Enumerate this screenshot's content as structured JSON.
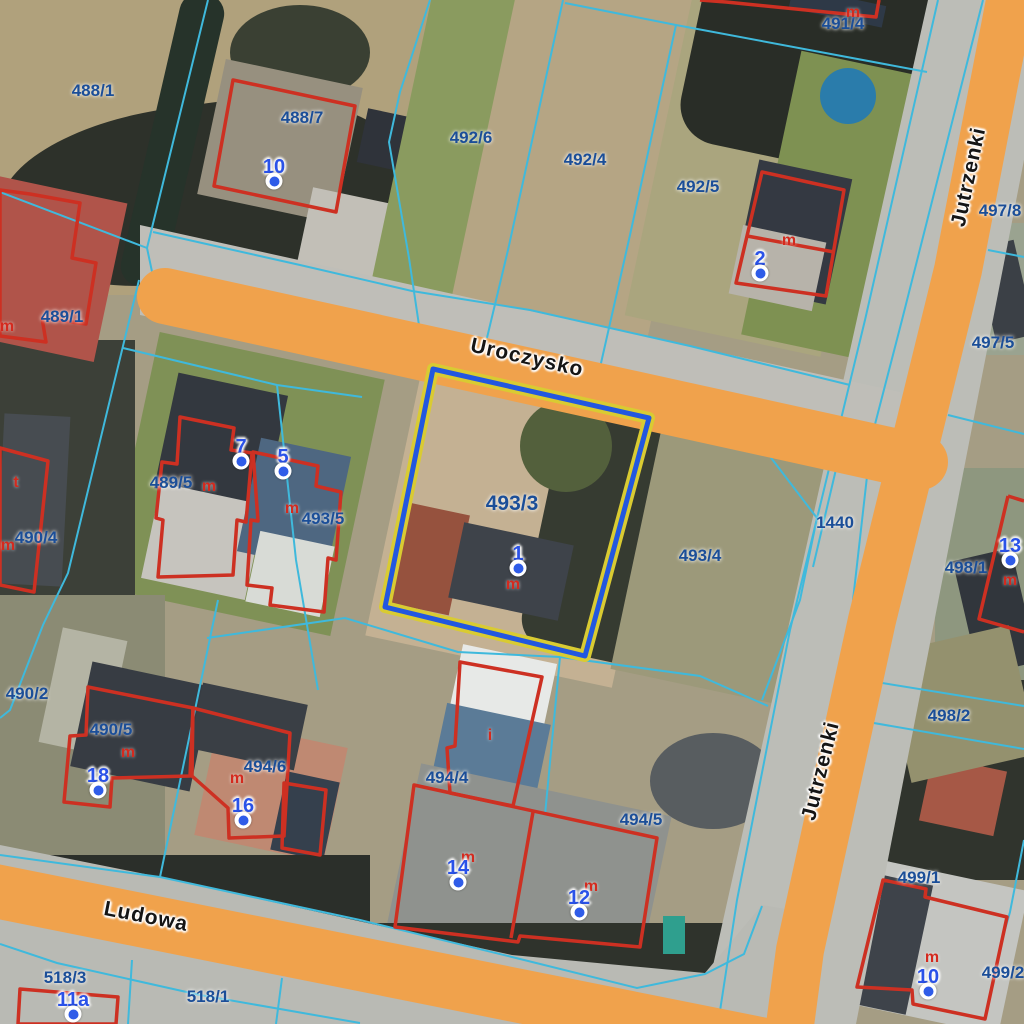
{
  "map": {
    "type": "cadastral-aerial-map",
    "streets": [
      {
        "name": "Uroczysko",
        "x": 527,
        "y": 358,
        "rot": 12.5
      },
      {
        "name": "Jutrzenki",
        "x": 969,
        "y": 177,
        "rot": -78
      },
      {
        "name": "Jutrzenki",
        "x": 821,
        "y": 771,
        "rot": -76
      },
      {
        "name": "Ludowa",
        "x": 146,
        "y": 917,
        "rot": 11
      }
    ],
    "parcel_labels": [
      {
        "text": "488/1",
        "x": 93,
        "y": 91
      },
      {
        "text": "488/7",
        "x": 302,
        "y": 118
      },
      {
        "text": "492/6",
        "x": 471,
        "y": 138
      },
      {
        "text": "492/4",
        "x": 585,
        "y": 160
      },
      {
        "text": "492/5",
        "x": 698,
        "y": 187
      },
      {
        "text": "491/4",
        "x": 843,
        "y": 24
      },
      {
        "text": "497/8",
        "x": 1000,
        "y": 211
      },
      {
        "text": "497/5",
        "x": 993,
        "y": 343
      },
      {
        "text": "489/1",
        "x": 62,
        "y": 317
      },
      {
        "text": "493/6",
        "x": 418,
        "y": 349,
        "under_road": true
      },
      {
        "text": "489/5",
        "x": 171,
        "y": 483
      },
      {
        "text": "493/5",
        "x": 323,
        "y": 519
      },
      {
        "text": "490/4",
        "x": 36,
        "y": 538
      },
      {
        "text": "493/3",
        "x": 512,
        "y": 504,
        "big": true
      },
      {
        "text": "493/4",
        "x": 700,
        "y": 556
      },
      {
        "text": "1440",
        "x": 835,
        "y": 523
      },
      {
        "text": "498/1",
        "x": 966,
        "y": 568
      },
      {
        "text": "490/2",
        "x": 27,
        "y": 694
      },
      {
        "text": "490/5",
        "x": 111,
        "y": 730
      },
      {
        "text": "494/6",
        "x": 265,
        "y": 767
      },
      {
        "text": "494/4",
        "x": 447,
        "y": 778
      },
      {
        "text": "498/2",
        "x": 949,
        "y": 716
      },
      {
        "text": "494/5",
        "x": 641,
        "y": 820
      },
      {
        "text": "499/1",
        "x": 919,
        "y": 878
      },
      {
        "text": "518/3",
        "x": 65,
        "y": 978
      },
      {
        "text": "518/1",
        "x": 208,
        "y": 997
      },
      {
        "text": "499/2",
        "x": 1003,
        "y": 973
      }
    ],
    "annotation_letters": [
      {
        "text": "m",
        "x": 853,
        "y": 13
      },
      {
        "text": "m",
        "x": 789,
        "y": 241
      },
      {
        "text": "m",
        "x": 7,
        "y": 327
      },
      {
        "text": "t",
        "x": 16,
        "y": 483
      },
      {
        "text": "m",
        "x": 209,
        "y": 487
      },
      {
        "text": "m",
        "x": 292,
        "y": 509
      },
      {
        "text": "m",
        "x": 8,
        "y": 546
      },
      {
        "text": "m",
        "x": 513,
        "y": 585
      },
      {
        "text": "i",
        "x": 490,
        "y": 736
      },
      {
        "text": "m",
        "x": 128,
        "y": 753
      },
      {
        "text": "m",
        "x": 237,
        "y": 779
      },
      {
        "text": "m",
        "x": 468,
        "y": 858
      },
      {
        "text": "m",
        "x": 591,
        "y": 887
      },
      {
        "text": "m",
        "x": 1010,
        "y": 581
      },
      {
        "text": "m",
        "x": 932,
        "y": 958
      }
    ],
    "address_points": [
      {
        "label": "10",
        "x": 274,
        "y": 181
      },
      {
        "label": "2",
        "x": 760,
        "y": 273
      },
      {
        "label": "7",
        "x": 241,
        "y": 461
      },
      {
        "label": "5",
        "x": 283,
        "y": 471
      },
      {
        "label": "1",
        "x": 518,
        "y": 568
      },
      {
        "label": "13",
        "x": 1010,
        "y": 560
      },
      {
        "label": "18",
        "x": 98,
        "y": 790
      },
      {
        "label": "16",
        "x": 243,
        "y": 820
      },
      {
        "label": "14",
        "x": 458,
        "y": 882
      },
      {
        "label": "12",
        "x": 579,
        "y": 912
      },
      {
        "label": "11a",
        "x": 73,
        "y": 1014
      },
      {
        "label": "10",
        "x": 928,
        "y": 991
      }
    ],
    "highlighted_parcel": {
      "id": "493/3"
    },
    "colors": {
      "road": "#f0a24c",
      "pavement": "#bcbdb7",
      "parcel_line": "#3fb9dc",
      "building_outline": "#cd3022",
      "parcel_label": "#1b4e98",
      "address_label": "#2a52e8",
      "annotation_letter": "#d42a1e",
      "highlight_outer": "#d9cb32",
      "highlight_inner": "#2257e0"
    }
  }
}
